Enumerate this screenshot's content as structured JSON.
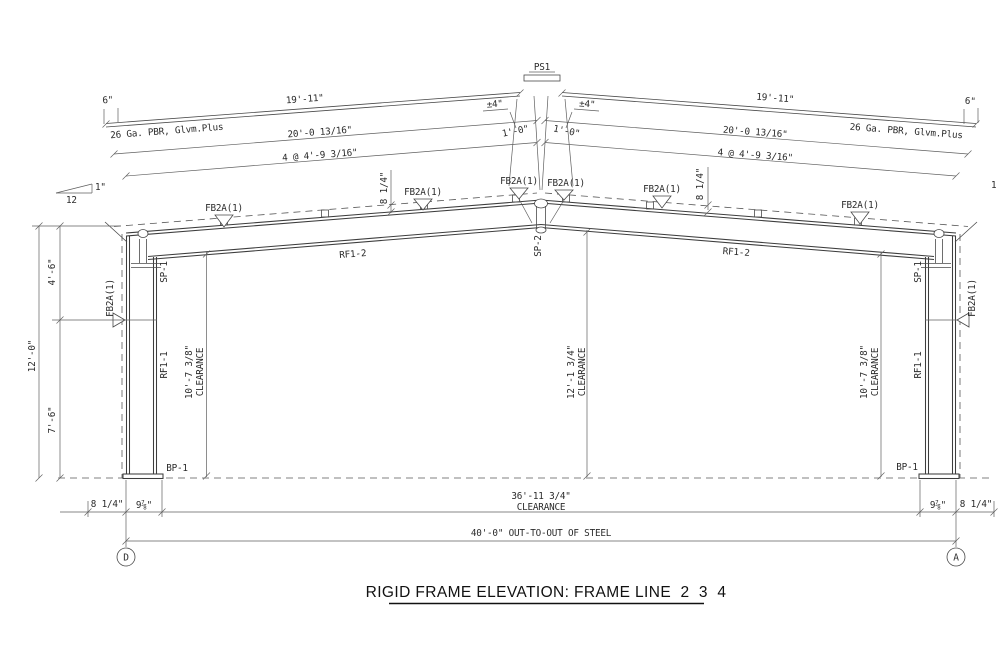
{
  "title": "RIGID FRAME ELEVATION: FRAME LINE  2  3  4",
  "grid_bubbles": {
    "left": "D",
    "right": "A"
  },
  "ridge": {
    "panel_strip_label": "PS1",
    "splice_label": "SP-2",
    "offset_left": "±4\"",
    "offset_right": "±4\"",
    "first_purlin_left": "1'-0\"",
    "first_purlin_right": "1'-0\"",
    "flange_brace_left": "FB2A(1)",
    "flange_brace_right": "FB2A(1)"
  },
  "roof_left": {
    "overhang": "6\"",
    "panel_length": "19'-11\"",
    "panel_note": "26 Ga. PBR, Glvm.Plus",
    "rafter_length": "20'-0 13/16\"",
    "purlin_spacing": "4 @ 4'-9 3/16\"",
    "purlin_depth": "8 1/4\"",
    "rafter_label": "RF1-2",
    "flange_braces": [
      "FB2A(1)",
      "FB2A(1)"
    ]
  },
  "roof_right": {
    "overhang": "6\"",
    "panel_length": "19'-11\"",
    "panel_note": "26 Ga. PBR, Glvm.Plus",
    "rafter_length": "20'-0 13/16\"",
    "purlin_spacing": "4 @ 4'-9 3/16\"",
    "purlin_depth": "8 1/4\"",
    "rafter_label": "RF1-2",
    "flange_braces": [
      "FB2A(1)",
      "FB2A(1)"
    ]
  },
  "slope_symbol": {
    "rise": "1\"",
    "run": "12"
  },
  "column_left": {
    "splice_label": "SP-1",
    "member_label": "RF1-1",
    "clearance_dim": "10'-7 3/8\"",
    "clearance_word": "CLEARANCE",
    "base_plate": "BP-1",
    "flange_brace": "FB2A(1)"
  },
  "column_right": {
    "splice_label": "SP-1",
    "member_label": "RF1-1",
    "clearance_dim": "10'-7 3/8\"",
    "clearance_word": "CLEARANCE",
    "base_plate": "BP-1",
    "flange_brace": "FB2A(1)"
  },
  "center": {
    "clearance_dim": "12'-1 3/4\"",
    "clearance_word": "CLEARANCE"
  },
  "height_dims": {
    "overall": "12'-0\"",
    "upper": "4'-6\"",
    "lower": "7'-6\""
  },
  "bottom_dims": {
    "left_offset": "8 1/4\"",
    "left_plate": "9⅞\"",
    "clear_span": "36'-11 3/4\"",
    "clear_span_word": "CLEARANCE",
    "out_to_out": "40'-0\" OUT-TO-OUT OF STEEL",
    "right_plate": "9⅞\"",
    "right_offset": "8 1/4\""
  },
  "edge_fragment": "1"
}
